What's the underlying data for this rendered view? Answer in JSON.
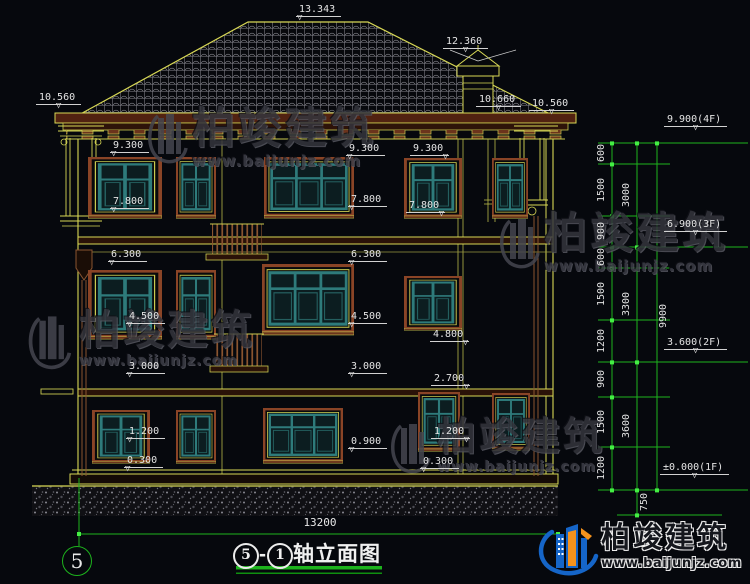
{
  "drawing": {
    "labels": {
      "ridge": "13.343",
      "chimney": "12.360",
      "eave_left": "10.560",
      "eave_right_inner": "10.660",
      "eave_right_outer": "10.560",
      "left": [
        "9.300",
        "7.800",
        "6.300",
        "4.500",
        "3.000",
        "1.200",
        "0.300"
      ],
      "center": [
        "9.300",
        "7.800",
        "6.300",
        "4.500",
        "3.000",
        "0.900",
        "0.300"
      ],
      "right": [
        "9.300",
        "7.800",
        "4.800",
        "2.700",
        "1.200"
      ]
    },
    "scale": {
      "levels": [
        "9.900(4F)",
        "6.900(3F)",
        "3.600(2F)",
        "±0.000(1F)"
      ],
      "minor": [
        "600",
        "1500",
        "900",
        "600",
        "1500",
        "1200",
        "900",
        "1500",
        "1200"
      ],
      "major": [
        "3000",
        "3300",
        "3600"
      ],
      "total": "9900",
      "below_ground": "750"
    },
    "footer": {
      "bottom_dimension": "13200",
      "axis_bubble": "5",
      "title_axis1": "5",
      "title_dash": "-",
      "title_axis2": "1",
      "title_text": "轴立面图"
    }
  },
  "brand": {
    "name": "柏竣建筑",
    "site": "www.baijunjz.com"
  },
  "colors": {
    "cad_yellow": "#d8d855",
    "dim_green": "#1db31d",
    "text_white": "#e4e4e4",
    "frame_brown": "#8a4426",
    "window_teal": "#2e7b7b",
    "logo_blue": "#1565c8",
    "logo_orange": "#f5921c"
  }
}
